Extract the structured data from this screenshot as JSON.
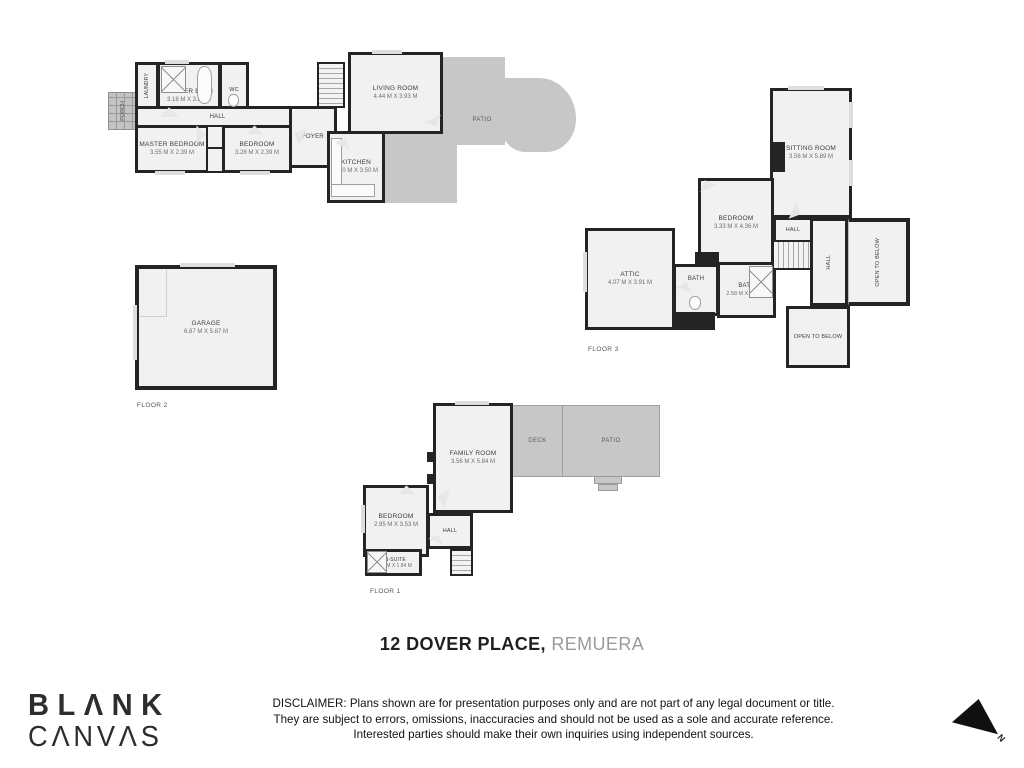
{
  "title": {
    "address_bold": "12 DOVER PLACE,",
    "address_light": " REMUERA"
  },
  "branding": {
    "logo_line1": "BLΛNK",
    "logo_line2": "CΛNVΛS"
  },
  "disclaimer": {
    "line1": "DISCLAIMER: Plans shown are for presentation purposes only and are not part of any legal document or title.",
    "line2": "They are subject to errors, omissions, inaccuracies and should not be used as a sole and accurate reference.",
    "line3": "Interested parties should make their own inquiries using independent sources."
  },
  "compass": {
    "north_label": "N"
  },
  "colors": {
    "wall": "#242424",
    "floor": "#f1f1f1",
    "outdoor": "#c7c7c7"
  },
  "plans": {
    "floor2": {
      "floor_label": "FLOOR 2",
      "rooms": {
        "porch": {
          "name": "PORCH"
        },
        "laundry": {
          "name": "LAUNDRY"
        },
        "master_bath": {
          "name": "MASTER BATH",
          "dims": "3.18 M X 3.01 M"
        },
        "wc": {
          "name": "WC"
        },
        "hall": {
          "name": "HALL"
        },
        "master_bedroom": {
          "name": "MASTER BEDROOM",
          "dims": "3.55 M X 2.39 M"
        },
        "bedroom": {
          "name": "BEDROOM",
          "dims": "3.28 M X 2.39 M"
        },
        "foyer": {
          "name": "FOYER"
        },
        "living_room": {
          "name": "LIVING ROOM",
          "dims": "4.44 M X 3.93 M"
        },
        "kitchen": {
          "name": "KITCHEN",
          "dims": "2.70 M X 3.50 M"
        },
        "patio": {
          "name": "PATIO"
        },
        "garage": {
          "name": "GARAGE",
          "dims": "6.87 M X 5.87 M"
        }
      }
    },
    "floor3": {
      "floor_label": "FLOOR 3",
      "rooms": {
        "sitting_room": {
          "name": "SITTING ROOM",
          "dims": "3.56 M X 5.89 M"
        },
        "bedroom": {
          "name": "BEDROOM",
          "dims": "3.33 M X 4.36 M"
        },
        "attic": {
          "name": "ATTIC",
          "dims": "4.07 M X 3.91 M"
        },
        "bath1": {
          "name": "BATH"
        },
        "bath2": {
          "name": "BATH",
          "dims": "2.58 M X 2.59 M"
        },
        "hall_top": {
          "name": "HALL"
        },
        "hall_side": {
          "name": "HALL"
        },
        "open_below_right": {
          "name": "OPEN TO BELOW"
        },
        "open_below_bottom": {
          "name": "OPEN TO BELOW"
        }
      }
    },
    "floor1": {
      "floor_label": "FLOOR 1",
      "rooms": {
        "family_room": {
          "name": "FAMILY ROOM",
          "dims": "3.56 M X 5.84 M"
        },
        "deck": {
          "name": "DECK"
        },
        "patio": {
          "name": "PATIO"
        },
        "bedroom": {
          "name": "BEDROOM",
          "dims": "2.95 M X 3.53 M"
        },
        "hall": {
          "name": "HALL"
        },
        "ensuite": {
          "name": "EN-SUITE",
          "dims": "2.95 M X 1.84 M"
        }
      }
    }
  }
}
